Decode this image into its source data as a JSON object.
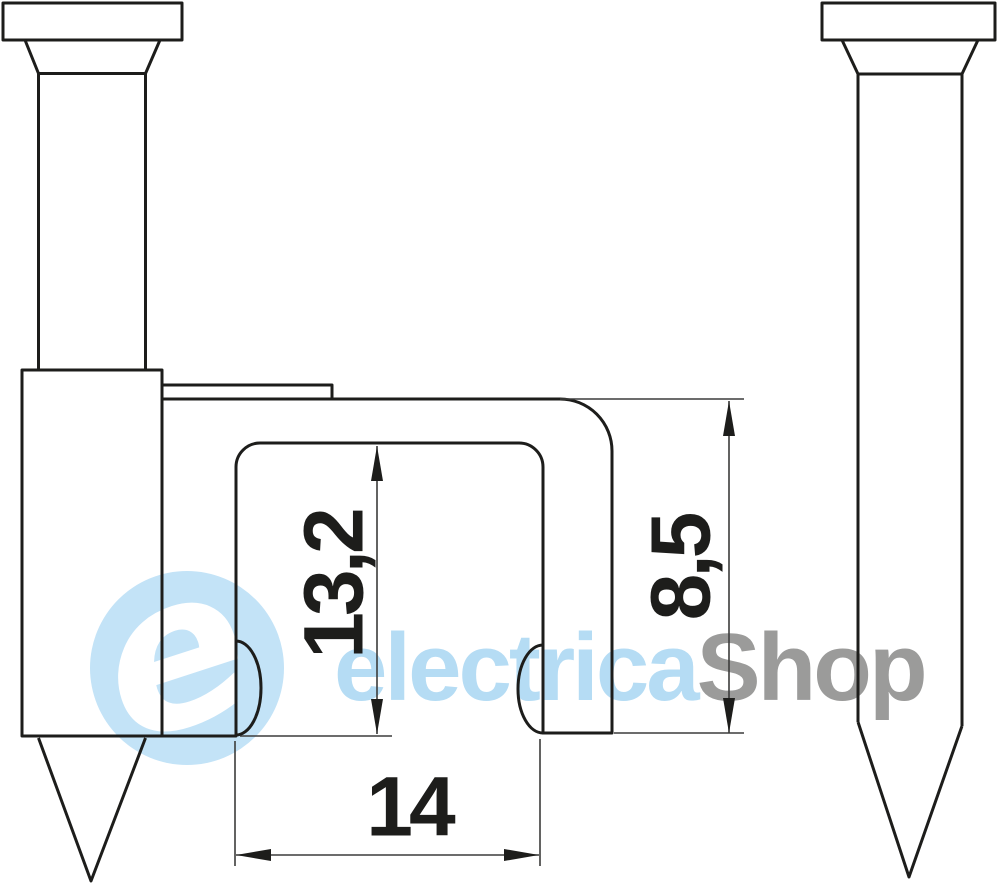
{
  "drawing": {
    "title": "flat cable clip with nail - dimensional drawing",
    "views": {
      "front": "cable clip with hammered nail",
      "side": "nail profile"
    },
    "dimensions": {
      "inner_height": "13,2",
      "outer_height": "8,5",
      "inner_width": "14"
    }
  },
  "watermark": {
    "logo_letter": "e",
    "brand_primary": "electrica",
    "brand_secondary": "Shop"
  },
  "colors": {
    "line_dark": "#1d1d1b",
    "dim_line": "#3c3c3b",
    "watermark_blue": "#b5dcf4",
    "logo_blue": "#c3e3f7",
    "watermark_gray": "#9b9b9a",
    "bg": "#ffffff"
  }
}
